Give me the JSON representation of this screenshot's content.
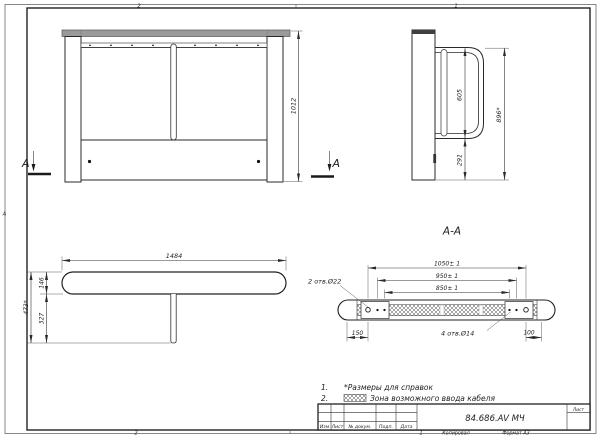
{
  "drawing": {
    "doc_number": "84.686.AV МЧ",
    "format_label": "Формат А3",
    "copied_label": "Копировал",
    "sheet_label": "Лист"
  },
  "zones": {
    "top_left": "2",
    "top_right": "1",
    "bottom_left": "2",
    "bottom_right": "1",
    "left_side": "A"
  },
  "title_block": {
    "col_izm": "Изм",
    "col_list": "Лист",
    "col_doc": "№ докум.",
    "col_podp": "Подп.",
    "col_data": "Дата"
  },
  "views": {
    "front": {
      "dim_height": "1012",
      "section_letter_left": "A",
      "section_letter_right": "A"
    },
    "side": {
      "dim_loop": "605",
      "dim_overall": "896*",
      "dim_lower": "291"
    },
    "top": {
      "dim_length": "1484",
      "dim_rail": "146",
      "dim_depth": "473*",
      "dim_base": "327"
    },
    "section": {
      "title": "A-A",
      "dim_outer": "1050± 1",
      "dim_mid": "950± 1",
      "dim_inner": "850± 1",
      "dim_left": "150",
      "dim_right": "100",
      "holes_22": "2 отв.Ø22",
      "holes_14": "4 отв.Ø14"
    }
  },
  "notes": {
    "n1_num": "1.",
    "n1_text": "*Размеры для справок",
    "n2_num": "2.",
    "n2_text": "Зона возможного ввода кабеля"
  },
  "colors": {
    "line": "#2a2a2a",
    "paper": "#ffffff",
    "rail_gray": "#9a9a9a"
  }
}
